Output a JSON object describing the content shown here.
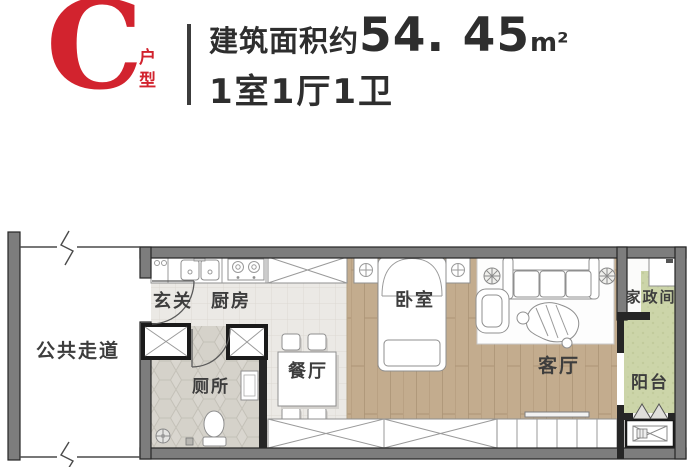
{
  "header": {
    "unit_letter": "C",
    "unit_suffix": "户型",
    "area_label": "建筑面积约",
    "area_value": "54. 45",
    "area_unit": "m²",
    "layout": "1室1厅1卫"
  },
  "rooms": {
    "corridor": "公共走道",
    "entry": "玄关",
    "kitchen": "厨房",
    "toilet": "厕所",
    "dining": "餐厅",
    "bedroom": "卧室",
    "living": "客厅",
    "utility": "家政间",
    "balcony": "阳台"
  },
  "colors": {
    "accent_red": "#d2232e",
    "text_dark": "#2e2e2e",
    "wall_gray": "#7d7d7d",
    "wall_dark": "#262626",
    "wood_floor": "#c3ac8e",
    "tile_floor": "#ebe9e5",
    "hex_tile_floor": "#d9d6cf",
    "balcony_green": "#ccd5a9"
  }
}
